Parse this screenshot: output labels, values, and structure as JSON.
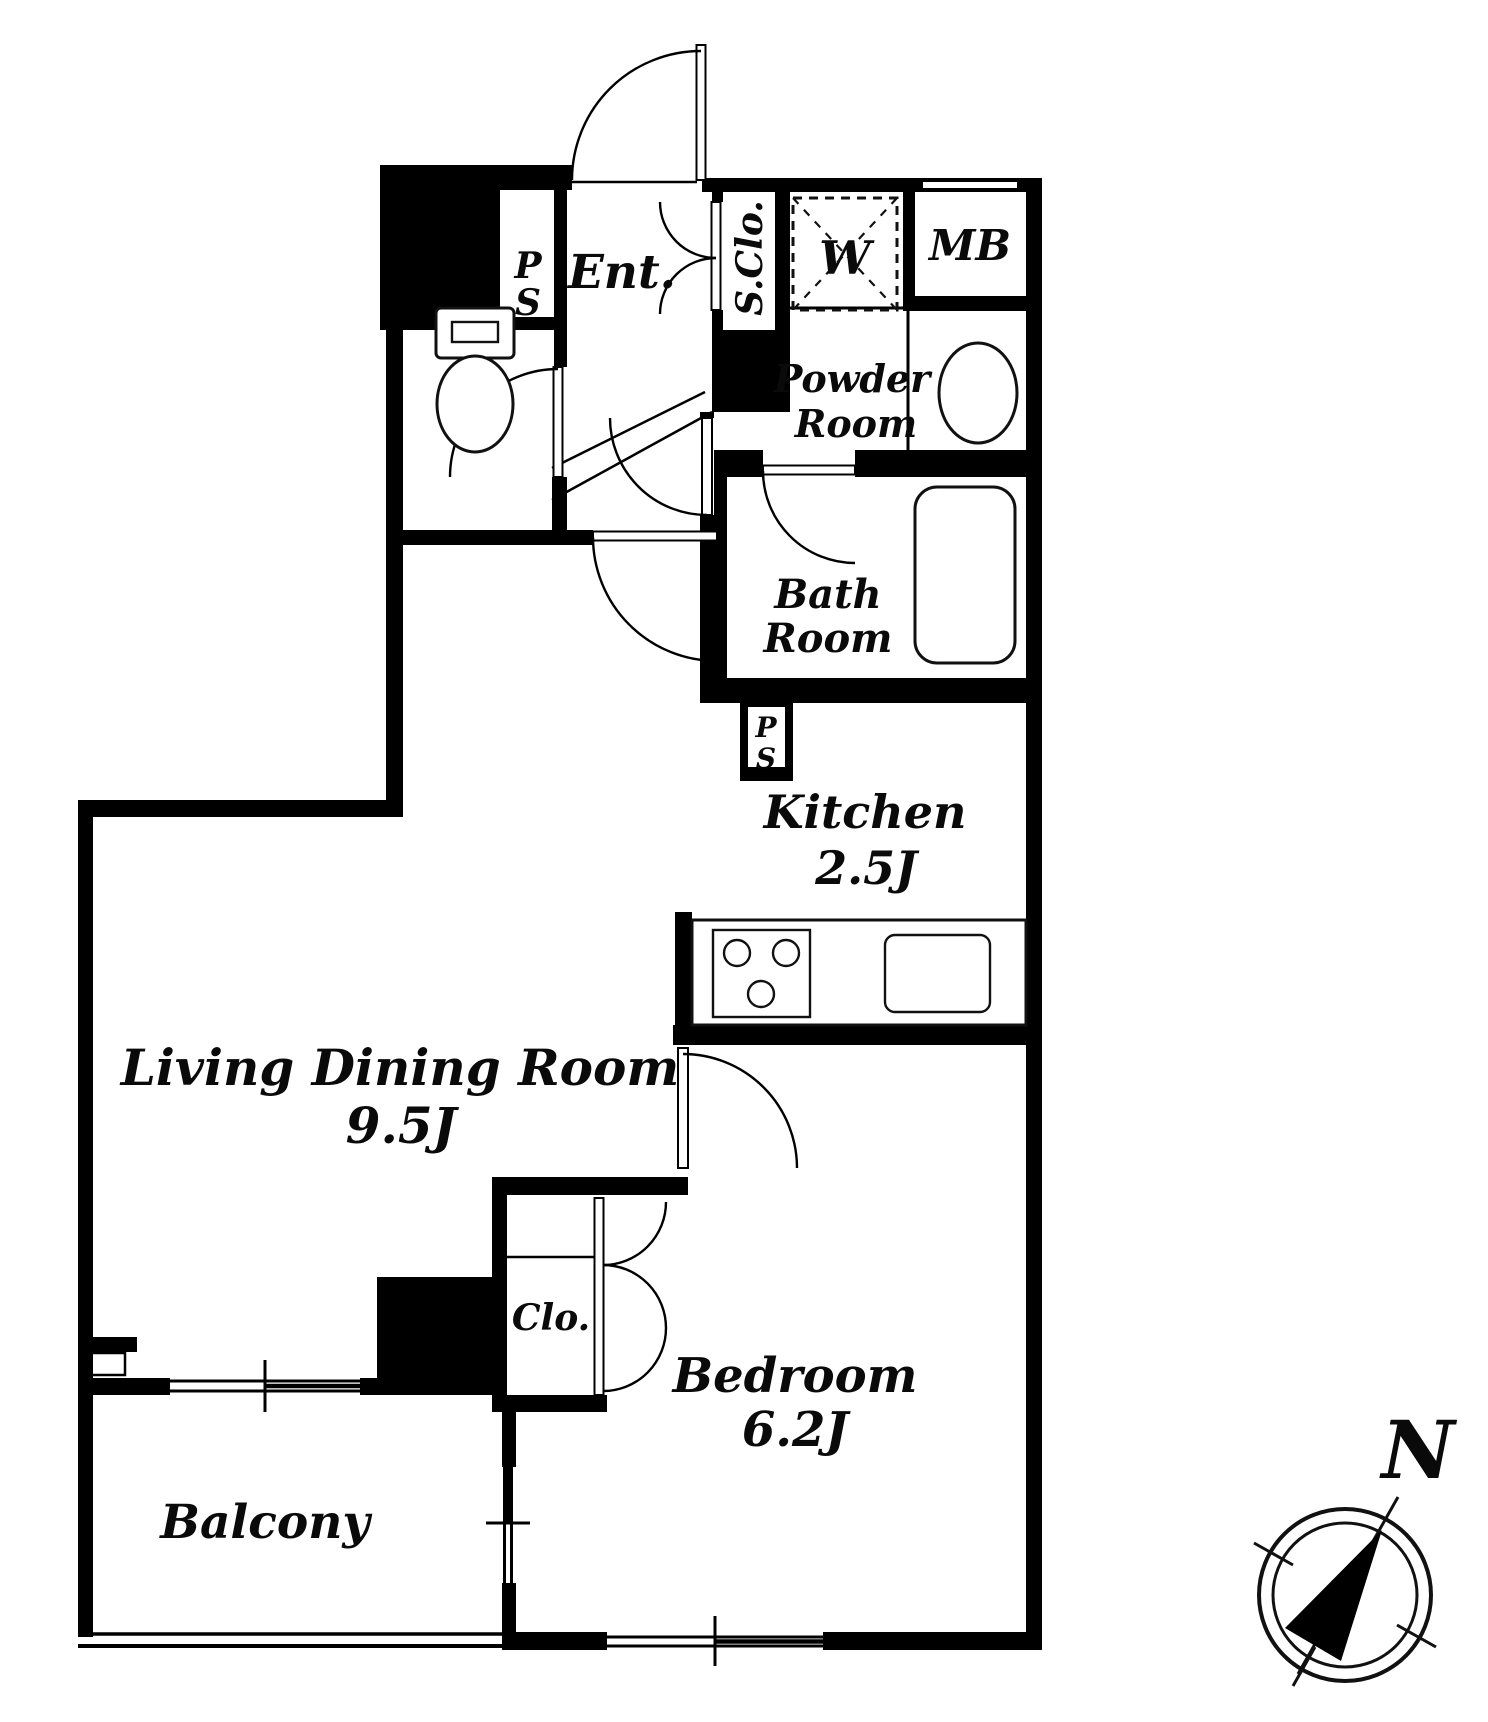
{
  "colors": {
    "wall": "#000000",
    "background": "#ffffff",
    "text": "#0a0a0a"
  },
  "rooms": {
    "entrance": {
      "name": "Ent."
    },
    "pipe_space_entrance": {
      "line1": "P",
      "line2": "S"
    },
    "shoe_closet": {
      "name": "S.Clo."
    },
    "washing_machine": {
      "name": "W"
    },
    "meter_box": {
      "name": "MB"
    },
    "powder_room": {
      "line1": "Powder",
      "line2": "Room"
    },
    "bath_room": {
      "line1": "Bath",
      "line2": "Room"
    },
    "pipe_space_kitchen": {
      "line1": "P",
      "line2": "S"
    },
    "kitchen": {
      "name": "Kitchen",
      "size": "2.5J"
    },
    "living_dining_room": {
      "name": "Living Dining Room",
      "size": "9.5J"
    },
    "closet": {
      "name": "Clo."
    },
    "bedroom": {
      "name": "Bedroom",
      "size": "6.2J"
    },
    "balcony": {
      "name": "Balcony"
    }
  },
  "compass": {
    "north": "N"
  }
}
